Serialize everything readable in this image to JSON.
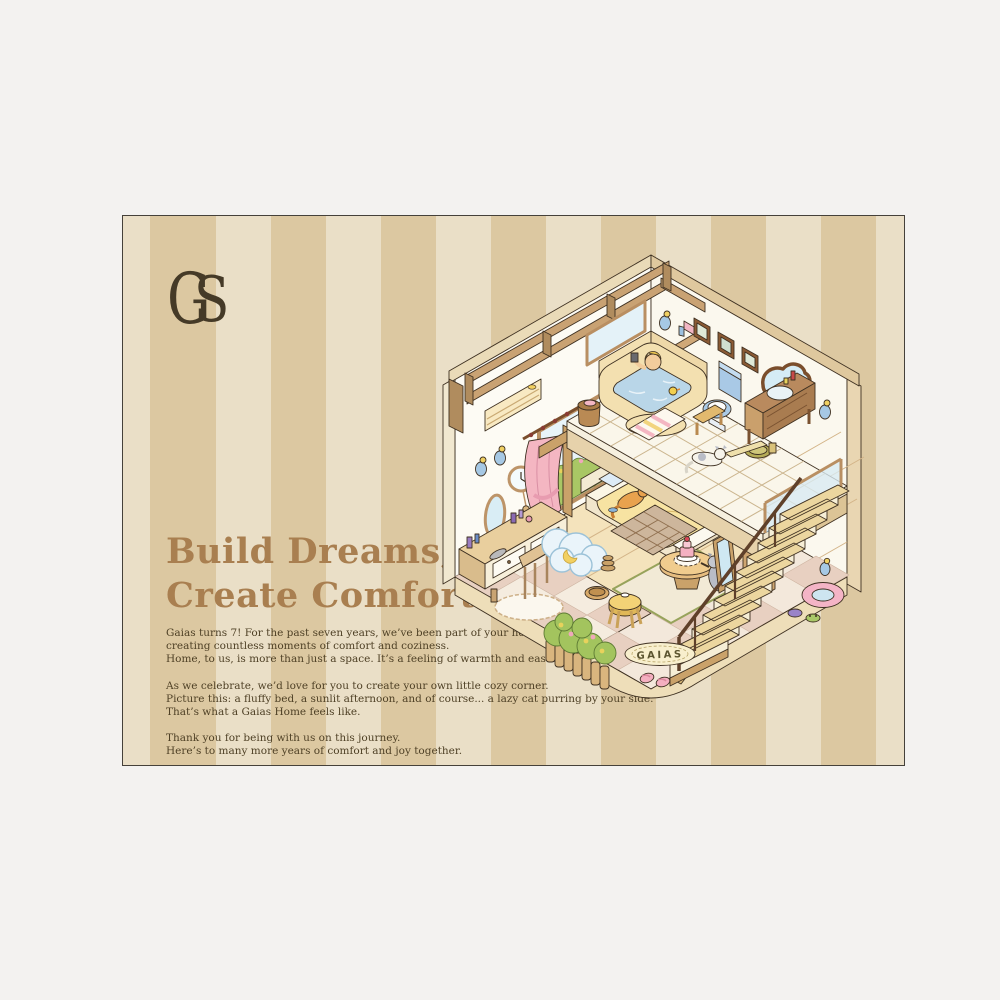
{
  "poster": {
    "stripe_light": "#eadfc7",
    "stripe_dark": "#dcc8a1",
    "heading_color": "#a97f50",
    "text_color": "#4f4126",
    "logo": {
      "letter_g": "G",
      "letter_s": "S",
      "color": "#453a27"
    },
    "headline": {
      "line1": "Build Dreams,",
      "line2": "Create Comfort"
    },
    "paragraphs": [
      {
        "lines": [
          "Gaias turns 7! For the past seven years, we’ve been part of your home,",
          "creating countless moments of comfort and coziness.",
          "Home, to us, is more than just a space. It’s a feeling of warmth and ease."
        ]
      },
      {
        "lines": [
          "As we celebrate, we’d love for you to create your own little cozy corner.",
          "Picture this: a fluffy bed, a sunlit afternoon, and of course... a lazy cat purring by your side.",
          "That’s what a Gaias Home feels like."
        ]
      },
      {
        "lines": [
          "Thank you for being with us on this journey.",
          "Here’s to many more years of comfort and joy together."
        ]
      }
    ],
    "illustration": {
      "rug_text": "GAIAS",
      "wood": "#c9a273",
      "wall": "#fdfbf4",
      "water": "#b9d6e8",
      "curtain_pink": "#f4b6c2",
      "hedge_green": "#a9c765"
    }
  }
}
